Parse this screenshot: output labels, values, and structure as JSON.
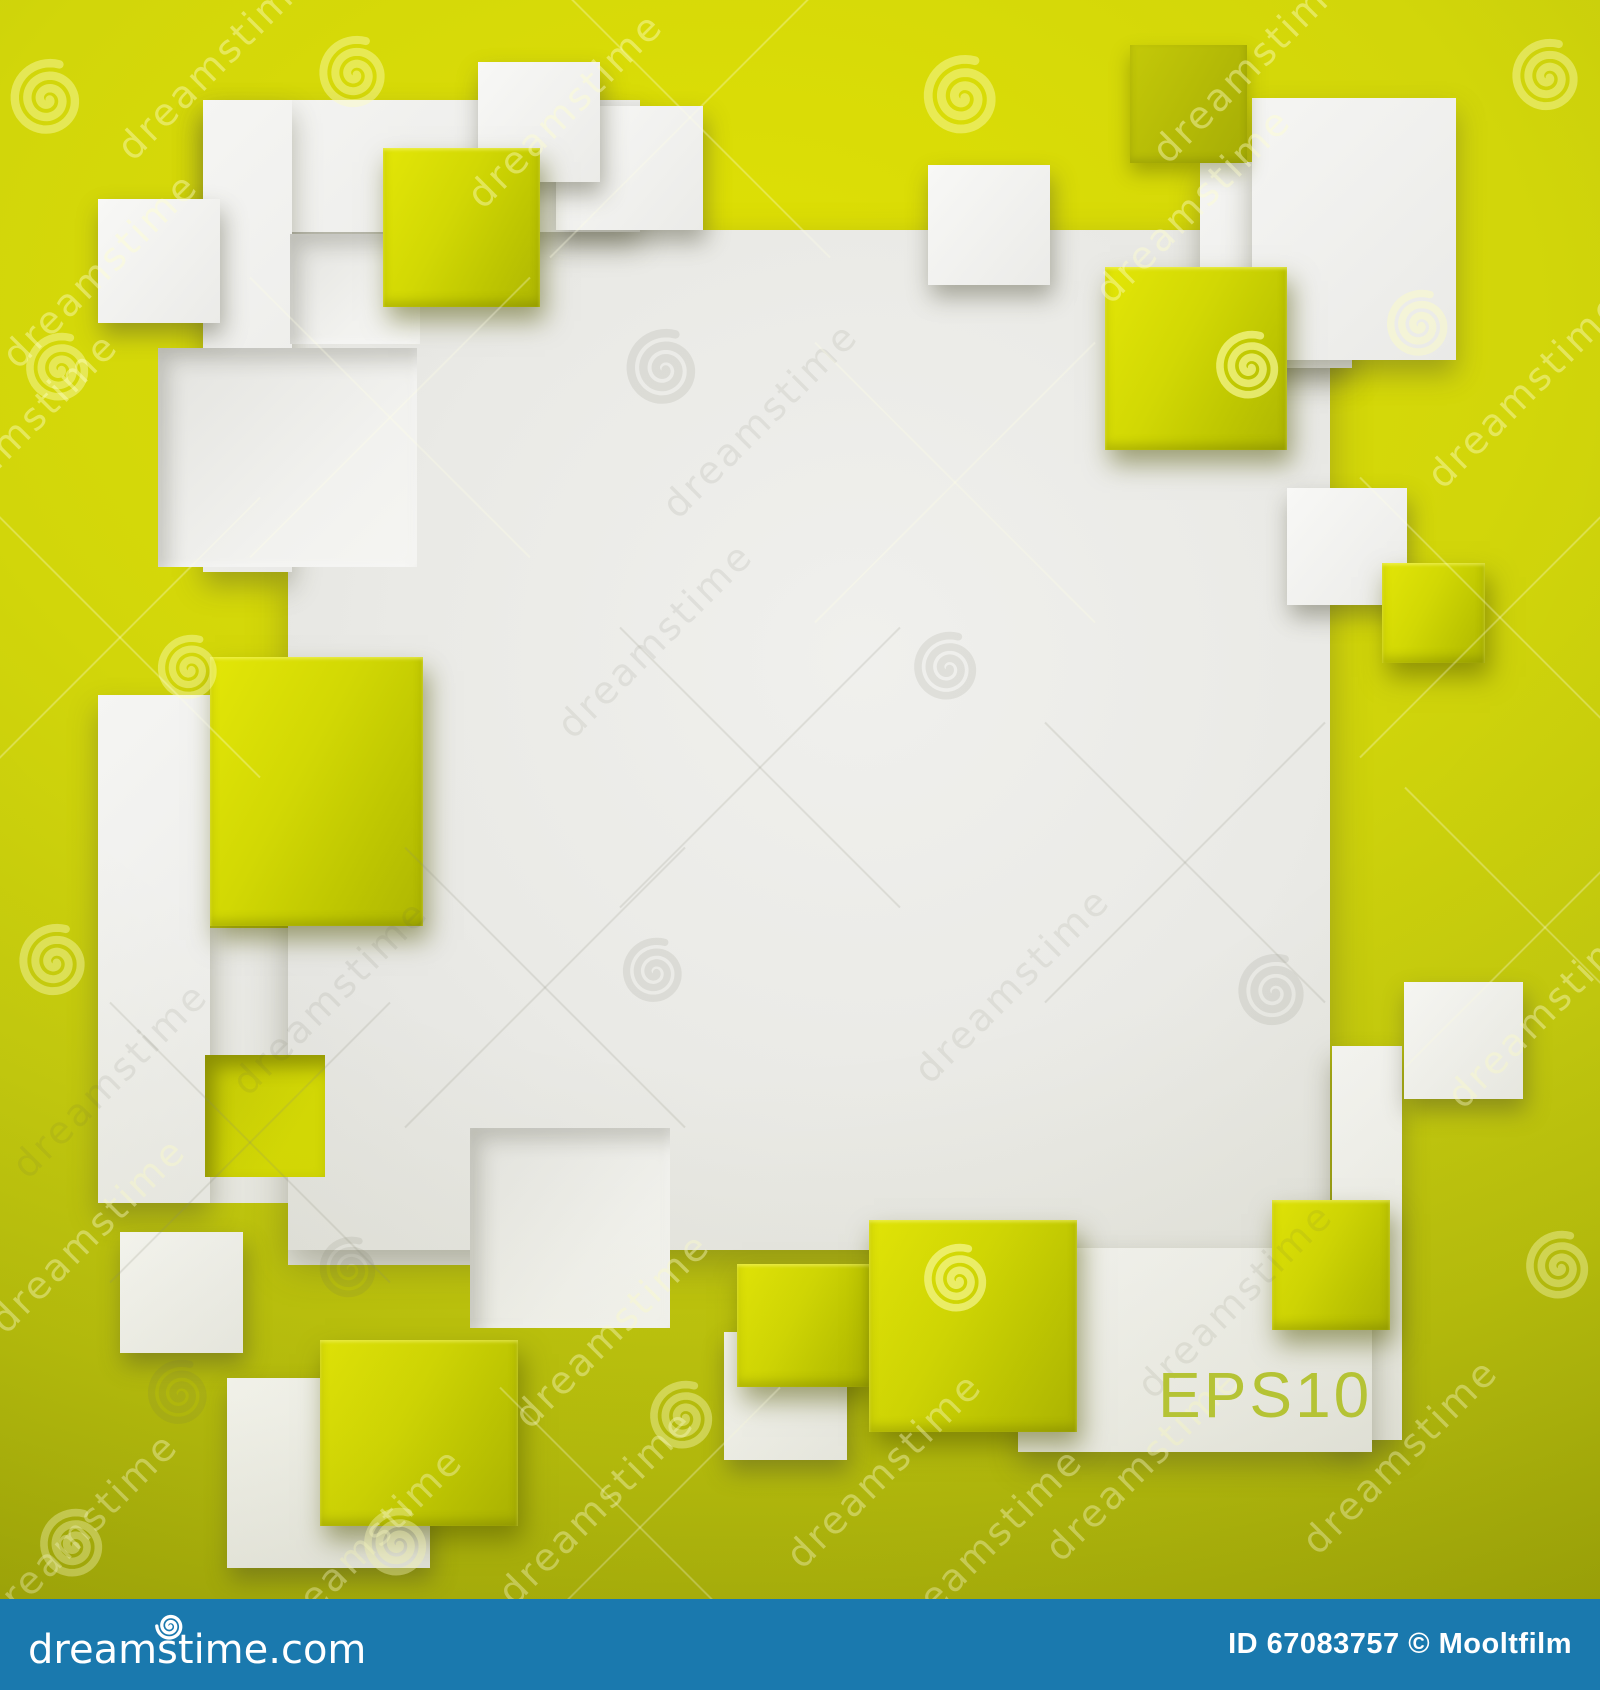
{
  "canvas": {
    "width": 1600,
    "height": 1690
  },
  "colors": {
    "background_yellow": "#ccd10c",
    "background_yellow_bright": "#dfe004",
    "background_yellow_dark": "#a3aa08",
    "glossy_square_yellow": "#d2d804",
    "olive_square": "#b2b806",
    "white_square": "#f4f4f2",
    "panel_white": "#eaeae6",
    "footer_bar_blue": "#1a79ae",
    "eps_label_green": "#b5c335",
    "watermark_light": "#ffffcd",
    "footer_text": "#ffffff"
  },
  "label": {
    "text": "EPS10"
  },
  "footer": {
    "logo_text": "dreamstime.com",
    "id_text": "ID 67083757 © Mooltfilm"
  },
  "watermark": {
    "brand_text": "dreamstime",
    "spirals": [
      {
        "x": 48,
        "y": 102,
        "r": 42,
        "tone": "y"
      },
      {
        "x": 355,
        "y": 77,
        "r": 40,
        "tone": "y"
      },
      {
        "x": 963,
        "y": 100,
        "r": 44,
        "tone": "y"
      },
      {
        "x": 1548,
        "y": 80,
        "r": 40,
        "tone": "y"
      },
      {
        "x": 60,
        "y": 372,
        "r": 38,
        "tone": "y"
      },
      {
        "x": 664,
        "y": 372,
        "r": 42,
        "tone": "g"
      },
      {
        "x": 190,
        "y": 672,
        "r": 36,
        "tone": "y"
      },
      {
        "x": 948,
        "y": 671,
        "r": 38,
        "tone": "g"
      },
      {
        "x": 655,
        "y": 975,
        "r": 36,
        "tone": "g"
      },
      {
        "x": 55,
        "y": 965,
        "r": 40,
        "tone": "y"
      },
      {
        "x": 1250,
        "y": 370,
        "r": 38,
        "tone": "yl"
      },
      {
        "x": 1420,
        "y": 328,
        "r": 37,
        "tone": "y"
      },
      {
        "x": 1274,
        "y": 995,
        "r": 40,
        "tone": "g"
      },
      {
        "x": 958,
        "y": 1283,
        "r": 38,
        "tone": "yl"
      },
      {
        "x": 350,
        "y": 1272,
        "r": 34,
        "tone": "g"
      },
      {
        "x": 180,
        "y": 1397,
        "r": 36,
        "tone": "g"
      },
      {
        "x": 1560,
        "y": 1270,
        "r": 38,
        "tone": "y"
      },
      {
        "x": 74,
        "y": 1548,
        "r": 38,
        "tone": "y"
      },
      {
        "x": 398,
        "y": 1547,
        "r": 38,
        "tone": "y"
      },
      {
        "x": 684,
        "y": 1420,
        "r": 38,
        "tone": "y"
      }
    ],
    "texts": [
      {
        "x": 100,
        "y": 270,
        "tone": "y"
      },
      {
        "x": 215,
        "y": 62,
        "tone": "y"
      },
      {
        "x": 565,
        "y": 110,
        "tone": "y"
      },
      {
        "x": 1250,
        "y": 65,
        "tone": "y"
      },
      {
        "x": 1525,
        "y": 390,
        "tone": "y"
      },
      {
        "x": 20,
        "y": 430,
        "tone": "y"
      },
      {
        "x": 1193,
        "y": 205,
        "tone": "y"
      },
      {
        "x": 655,
        "y": 640,
        "tone": "g"
      },
      {
        "x": 1012,
        "y": 985,
        "tone": "g"
      },
      {
        "x": 330,
        "y": 997,
        "tone": "g"
      },
      {
        "x": 110,
        "y": 1080,
        "tone": "g"
      },
      {
        "x": 760,
        "y": 420,
        "tone": "g"
      },
      {
        "x": 1235,
        "y": 1300,
        "tone": "g"
      },
      {
        "x": 88,
        "y": 1235,
        "tone": "y"
      },
      {
        "x": 612,
        "y": 1330,
        "tone": "y"
      },
      {
        "x": 80,
        "y": 1530,
        "tone": "y"
      },
      {
        "x": 365,
        "y": 1545,
        "tone": "y"
      },
      {
        "x": 596,
        "y": 1507,
        "tone": "y"
      },
      {
        "x": 884,
        "y": 1470,
        "tone": "y"
      },
      {
        "x": 1143,
        "y": 1463,
        "tone": "y"
      },
      {
        "x": 1400,
        "y": 1456,
        "tone": "y"
      },
      {
        "x": 1545,
        "y": 1010,
        "tone": "y"
      },
      {
        "x": 985,
        "y": 1545,
        "tone": "y"
      }
    ],
    "crosses": [
      {
        "x": 390,
        "y": 420,
        "tone": "y"
      },
      {
        "x": 120,
        "y": 640,
        "tone": "y"
      },
      {
        "x": 955,
        "y": 485,
        "tone": "y"
      },
      {
        "x": 1500,
        "y": 620,
        "tone": "y"
      },
      {
        "x": 690,
        "y": 120,
        "tone": "y"
      },
      {
        "x": 1545,
        "y": 930,
        "tone": "y"
      },
      {
        "x": 640,
        "y": 1530,
        "tone": "y"
      },
      {
        "x": 760,
        "y": 770,
        "tone": "g"
      },
      {
        "x": 1185,
        "y": 865,
        "tone": "g"
      },
      {
        "x": 545,
        "y": 990,
        "tone": "g"
      },
      {
        "x": 250,
        "y": 1145,
        "tone": "g"
      }
    ]
  },
  "art": {
    "shapes": [
      {
        "name": "panel-extension-a",
        "kind": "panel-flat",
        "x": 210,
        "y": 928,
        "w": 260,
        "h": 275
      },
      {
        "name": "panel-extension-b",
        "kind": "panel-flat",
        "x": 288,
        "y": 1060,
        "w": 182,
        "h": 205
      },
      {
        "name": "central-panel",
        "kind": "panel-main",
        "x": 288,
        "y": 230,
        "w": 1042,
        "h": 1020
      },
      {
        "name": "top-left-band",
        "kind": "white-lg",
        "x": 203,
        "y": 100,
        "w": 437,
        "h": 132
      },
      {
        "name": "left-white-strip",
        "kind": "white-lg",
        "x": 203,
        "y": 100,
        "w": 89,
        "h": 472
      },
      {
        "name": "white-square-e2",
        "kind": "white",
        "x": 556,
        "y": 106,
        "w": 147,
        "h": 124
      },
      {
        "name": "top-right-square-2",
        "kind": "white-lg",
        "x": 1200,
        "y": 162,
        "w": 152,
        "h": 206
      },
      {
        "name": "top-right-square-1",
        "kind": "white-lg",
        "x": 1252,
        "y": 98,
        "w": 204,
        "h": 262
      },
      {
        "name": "right-white-strip",
        "kind": "white-lg",
        "x": 1332,
        "y": 1046,
        "w": 70,
        "h": 394
      },
      {
        "name": "eps-band",
        "kind": "white-lg",
        "x": 1018,
        "y": 1248,
        "w": 354,
        "h": 204
      },
      {
        "name": "left-white-column",
        "kind": "white-lg",
        "x": 98,
        "y": 695,
        "w": 112,
        "h": 508
      },
      {
        "name": "recess-notch",
        "kind": "recess_white",
        "x": 290,
        "y": 234,
        "w": 130,
        "h": 110
      },
      {
        "name": "recess-square-left",
        "kind": "recess_white",
        "x": 158,
        "y": 348,
        "w": 259,
        "h": 219
      },
      {
        "name": "recess-square-bottom",
        "kind": "recess_white",
        "x": 470,
        "y": 1128,
        "w": 200,
        "h": 200
      },
      {
        "name": "recess-yellow-square",
        "kind": "recess_yellow",
        "x": 205,
        "y": 1055,
        "w": 120,
        "h": 122
      },
      {
        "name": "white-square-topleft",
        "kind": "white",
        "x": 98,
        "y": 199,
        "w": 122,
        "h": 124
      },
      {
        "name": "white-square-top",
        "kind": "white",
        "x": 478,
        "y": 62,
        "w": 122,
        "h": 120
      },
      {
        "name": "yellow-square-c",
        "kind": "glossy",
        "x": 383,
        "y": 148,
        "w": 157,
        "h": 159
      },
      {
        "name": "white-square-d",
        "kind": "white",
        "x": 928,
        "y": 165,
        "w": 122,
        "h": 120
      },
      {
        "name": "olive-square-top",
        "kind": "olive",
        "x": 1130,
        "y": 45,
        "w": 117,
        "h": 118
      },
      {
        "name": "yellow-square-h",
        "kind": "glossy",
        "x": 1105,
        "y": 267,
        "w": 182,
        "h": 183
      },
      {
        "name": "white-square-right-1",
        "kind": "white",
        "x": 1287,
        "y": 488,
        "w": 120,
        "h": 117
      },
      {
        "name": "yellow-square-j",
        "kind": "glossy",
        "x": 1382,
        "y": 563,
        "w": 103,
        "h": 100
      },
      {
        "name": "yellow-square-left",
        "kind": "glossy",
        "x": 210,
        "y": 657,
        "w": 213,
        "h": 269
      },
      {
        "name": "white-square-k",
        "kind": "white",
        "x": 120,
        "y": 1232,
        "w": 123,
        "h": 121
      },
      {
        "name": "white-square-l",
        "kind": "white",
        "x": 227,
        "y": 1378,
        "w": 203,
        "h": 190
      },
      {
        "name": "yellow-square-y4",
        "kind": "glossy",
        "x": 320,
        "y": 1340,
        "w": 198,
        "h": 186
      },
      {
        "name": "white-square-bc",
        "kind": "white",
        "x": 724,
        "y": 1332,
        "w": 123,
        "h": 128
      },
      {
        "name": "yellow-square-y5",
        "kind": "glossy",
        "x": 737,
        "y": 1264,
        "w": 134,
        "h": 123
      },
      {
        "name": "yellow-square-y6",
        "kind": "glossy",
        "x": 869,
        "y": 1220,
        "w": 208,
        "h": 212
      },
      {
        "name": "yellow-square-y7",
        "kind": "glossy",
        "x": 1272,
        "y": 1200,
        "w": 118,
        "h": 130
      },
      {
        "name": "white-square-right-2",
        "kind": "white",
        "x": 1404,
        "y": 982,
        "w": 119,
        "h": 117
      }
    ]
  }
}
